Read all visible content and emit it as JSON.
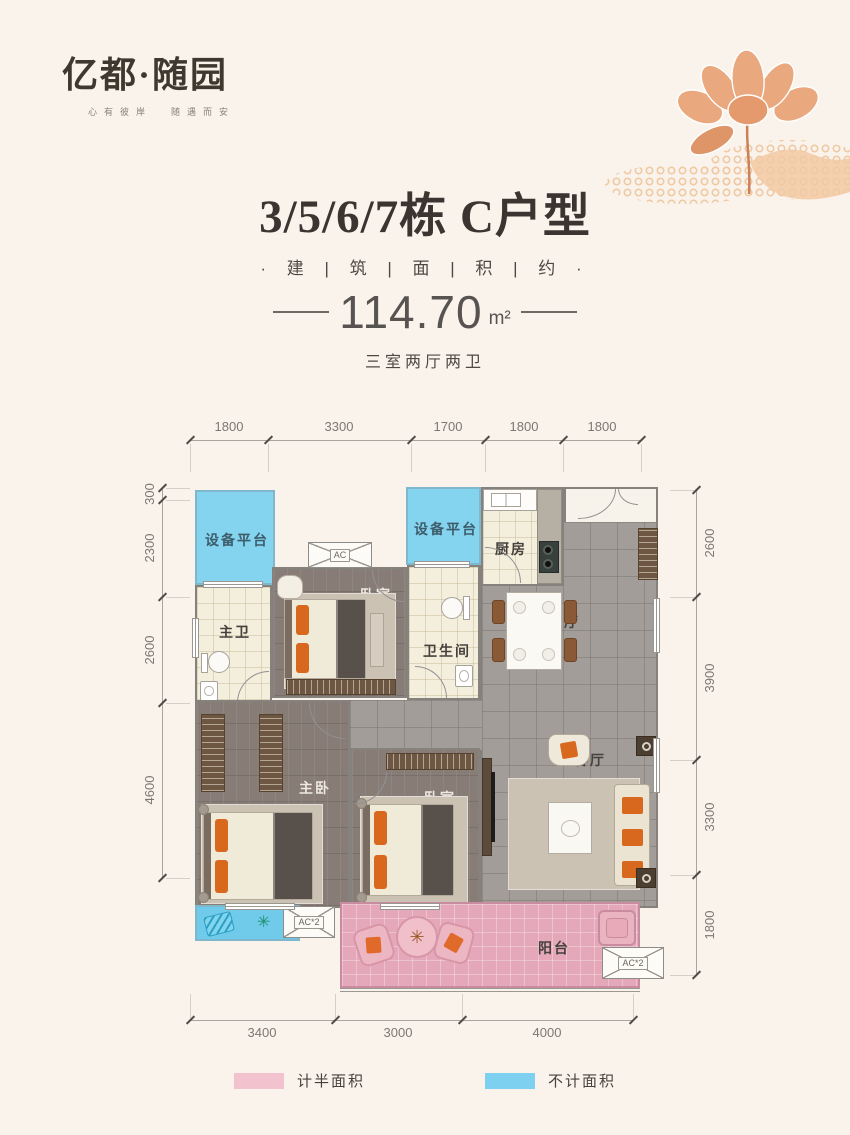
{
  "brand": {
    "logo": "亿都·随园",
    "tagline": "心有彼岸  随遇而安"
  },
  "title": {
    "main": "3/5/6/7栋 C户型",
    "subtitle": "· 建 | 筑 | 面 | 积 | 约 ·",
    "area_value": "114.70",
    "area_unit": "m²",
    "layout": "三室两厅两卫"
  },
  "plan": {
    "rooms": {
      "equipment_platform_1": "设备平台",
      "equipment_platform_2": "设备平台",
      "master_bath": "主卫",
      "bedroom_top": "卧室",
      "bathroom": "卫生间",
      "kitchen": "厨房",
      "dining": "餐厅",
      "living": "客厅",
      "master_bedroom": "主卧",
      "bedroom_bottom": "卧室",
      "balcony": "阳台"
    },
    "ac": {
      "top": "AC",
      "bottom_left": "AC*2",
      "bottom_right": "AC*2"
    },
    "dimensions": {
      "top": [
        "1800",
        "3300",
        "1700",
        "1800",
        "1800"
      ],
      "left": [
        "300",
        "2300",
        "2600",
        "4600"
      ],
      "right": [
        "2600",
        "3900",
        "3300",
        "1800"
      ],
      "bottom": [
        "3400",
        "3000",
        "4000"
      ]
    }
  },
  "legend": [
    {
      "label": "计半面积",
      "color": "#F2C2CF"
    },
    {
      "label": "不计面积",
      "color": "#7DD0F0"
    }
  ],
  "icons": {
    "plant": "✳"
  },
  "colors": {
    "background": "#FAF3EC",
    "balcony_pink": "#E5A8BA",
    "platform_blue": "#84D3EF",
    "tile_gray": "#A39D99",
    "wood_floor": "#877C76",
    "accent_orange": "#D9681F",
    "title_text": "#3A3530"
  }
}
